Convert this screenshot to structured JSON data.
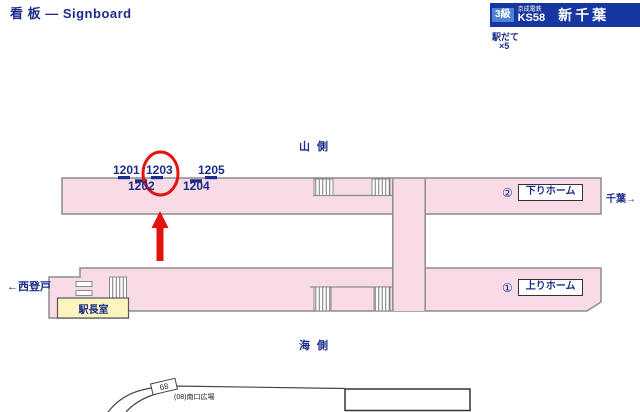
{
  "colors": {
    "navy": "#1b2c8a",
    "banner_blue": "#16379f",
    "badge_blue": "#4d82d8",
    "pink": "#f8dbe6",
    "border_gray": "#8c8c8c",
    "room_yellow": "#fbf4c1",
    "red": "#e3140e",
    "line_dark": "#444444",
    "ink": "#222222"
  },
  "title": "看 板 — Signboard",
  "banner": {
    "grade": "3級",
    "company": "京成電鉄",
    "code": "KS58",
    "station": "新千葉",
    "note1": "駅だて",
    "note2": "×5"
  },
  "sides": {
    "mountain": "山 側",
    "sea": "海 側"
  },
  "directions": {
    "left": "←西登戸",
    "right": "千葉→"
  },
  "platforms": {
    "down": {
      "number": "②",
      "name": "下りホーム"
    },
    "up": {
      "number": "①",
      "name": "上りホーム"
    }
  },
  "rooms": {
    "station_office": "駅長室"
  },
  "signboards": {
    "top_row": [
      {
        "id": "1201"
      },
      {
        "id": "1203"
      },
      {
        "id": "1205"
      }
    ],
    "bottom_row": [
      {
        "id": "1202"
      },
      {
        "id": "1204"
      }
    ],
    "highlighted": "1203"
  },
  "annotations": {
    "south_plaza": "(08)南口広場",
    "road_number": "68"
  }
}
